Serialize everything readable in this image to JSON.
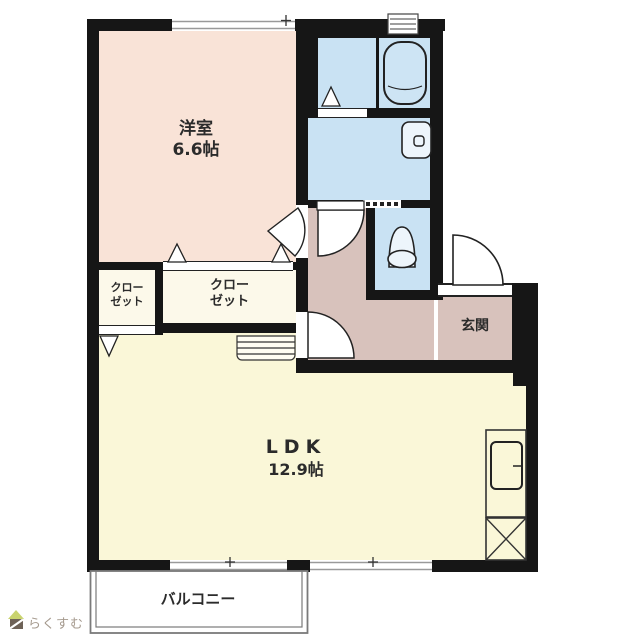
{
  "page": {
    "type": "floor-plan",
    "background": "#ffffff"
  },
  "colors": {
    "wall": "#161616",
    "western": "#f9e3d7",
    "ldk": "#faf7d8",
    "closet": "#fcf9ea",
    "water": "#c9e2f3",
    "fixture": "#edf5fb",
    "hall": "#d8c2bc",
    "window-line": "#999999",
    "balcony-line": "#7a7a7a",
    "label": "#2b2b2b",
    "brand-text": "#a59a8e",
    "brand-roof": "#c9d36e",
    "brand-body": "#6e6257"
  },
  "rooms": {
    "western_room": {
      "name": "洋室",
      "area": "6.6帖"
    },
    "ldk": {
      "name": "LDK",
      "area": "12.9帖"
    },
    "closet_left": {
      "line1": "クロー",
      "line2": "ゼット"
    },
    "closet_right": {
      "line1": "クロー",
      "line2": "ゼット"
    },
    "entrance": {
      "name": "玄関"
    },
    "balcony": {
      "name": "バルコニー"
    }
  },
  "brand": {
    "name": "らくすむ"
  },
  "fixtures": {
    "bathtub": "bathtub-icon",
    "toilet": "toilet-icon",
    "washbasin": "washbasin-icon",
    "kitchen_sink": "kitchen-sink-icon",
    "washer_space": "washer-space-icon",
    "vent": "vent-icon",
    "step": "step-icon"
  }
}
